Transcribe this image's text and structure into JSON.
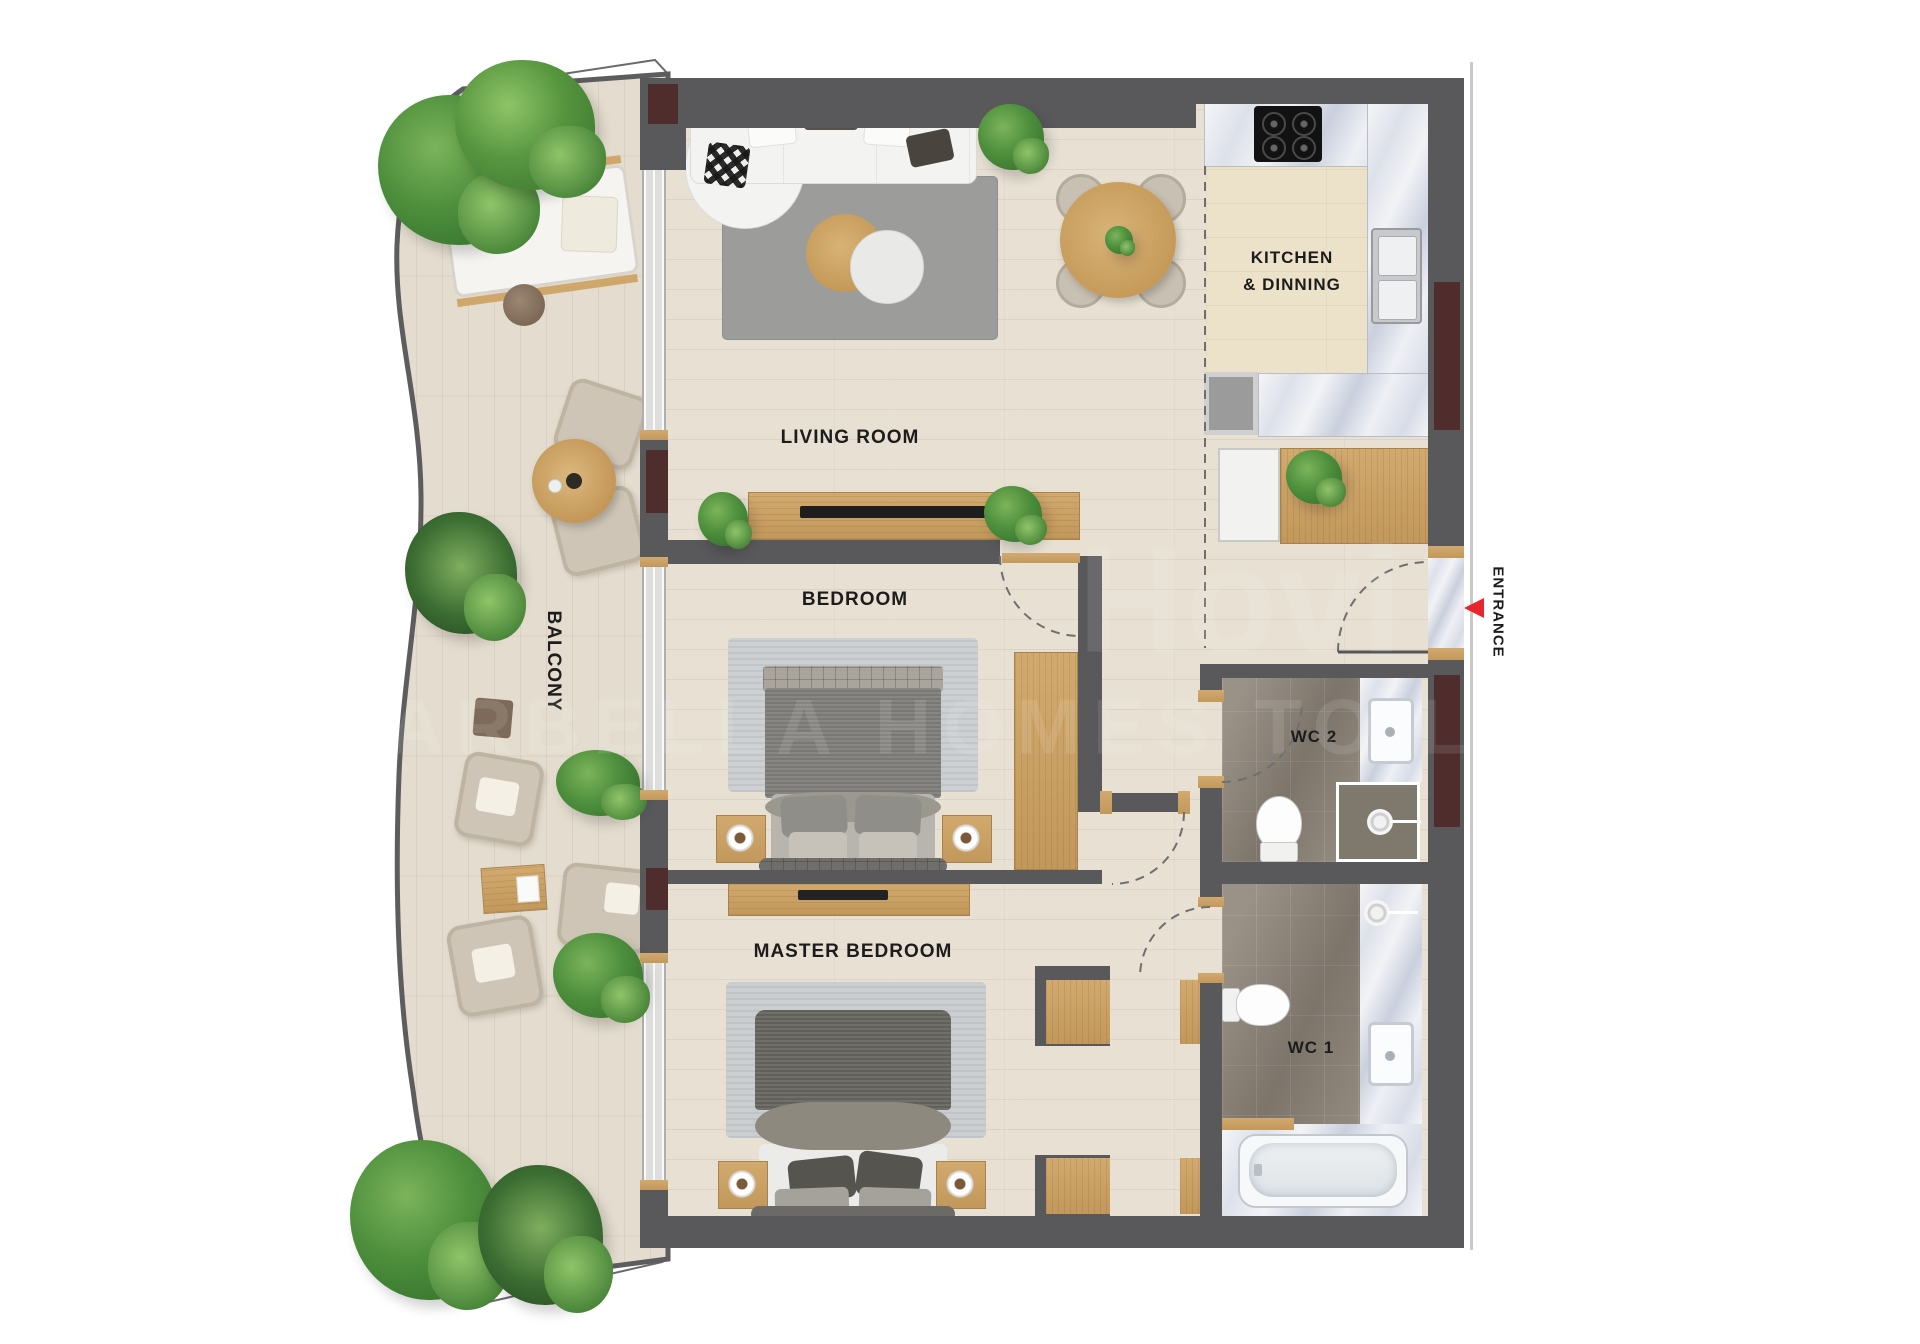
{
  "title": "Apartment floor plan",
  "rooms": {
    "living": "LIVING ROOM",
    "kitchen_line1": "KITCHEN",
    "kitchen_line2": "& DINNING",
    "bedroom": "BEDROOM",
    "master_bedroom": "MASTER BEDROOM",
    "balcony": "BALCONY",
    "wc1": "WC 1",
    "wc2": "WC 2",
    "entrance": "ENTRANCE"
  },
  "watermark": {
    "line1": "Hovi",
    "line2": "MARBELLA HOMES TO LOVE"
  },
  "colors": {
    "wall": "#59595b",
    "accent_maroon": "#4f2d2d",
    "wood": "#c9a262",
    "interior_floor": "#e7e0d3",
    "balcony_floor": "#e4ddcf",
    "wc_floor": "#8e8579",
    "rug_living": "#9c9d9b",
    "rug_bedroom": "#ccd0d2",
    "marble": "#e9ecf2",
    "entrance_arrow": "#e8252c",
    "label_text": "#1c1c1c"
  }
}
